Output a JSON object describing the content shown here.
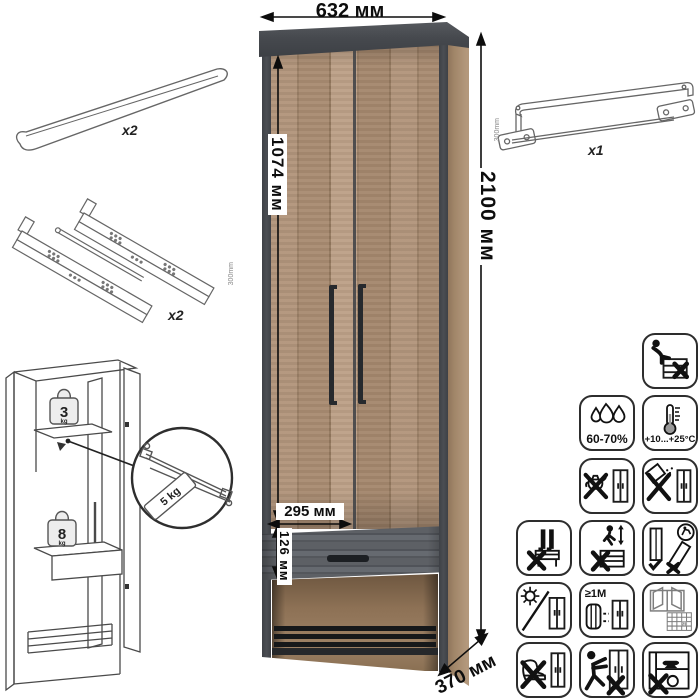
{
  "dimensions": {
    "width": "632 мм",
    "height": "2100 мм",
    "door_height": "1074 мм",
    "door_width": "295 мм",
    "drawer_height": "126 мм",
    "depth": "370 мм"
  },
  "parts": {
    "handle_qty": "x2",
    "slides_qty": "x2",
    "slides_length": "300mm",
    "rail_qty": "x1",
    "rail_length": "300mm"
  },
  "loads": {
    "shelf_value": "3",
    "shelf_unit": "kg",
    "rod": "5 kg",
    "drawer_value": "8",
    "drawer_unit": "kg"
  },
  "care": {
    "humidity": "60-70%",
    "temperature": "+10...+25°C",
    "min_distance": "≥1M",
    "ventilation_day": "21",
    "icons": [
      "no-sitting",
      "humidity-range",
      "temperature-range",
      "no-hot-kettle",
      "no-abrasive-powder",
      "no-standing",
      "no-jumping",
      "transport-upright-only",
      "no-direct-sunlight",
      "keep-distance-from-heaters",
      "ventilate-room",
      "no-kicking",
      "no-pushing-loaded",
      "no-overloading"
    ]
  },
  "colors": {
    "wood": "#ab8e71",
    "frame_dark": "#45484d",
    "drawer_wood": "#55585d",
    "line_art": "#4a4a4a"
  }
}
